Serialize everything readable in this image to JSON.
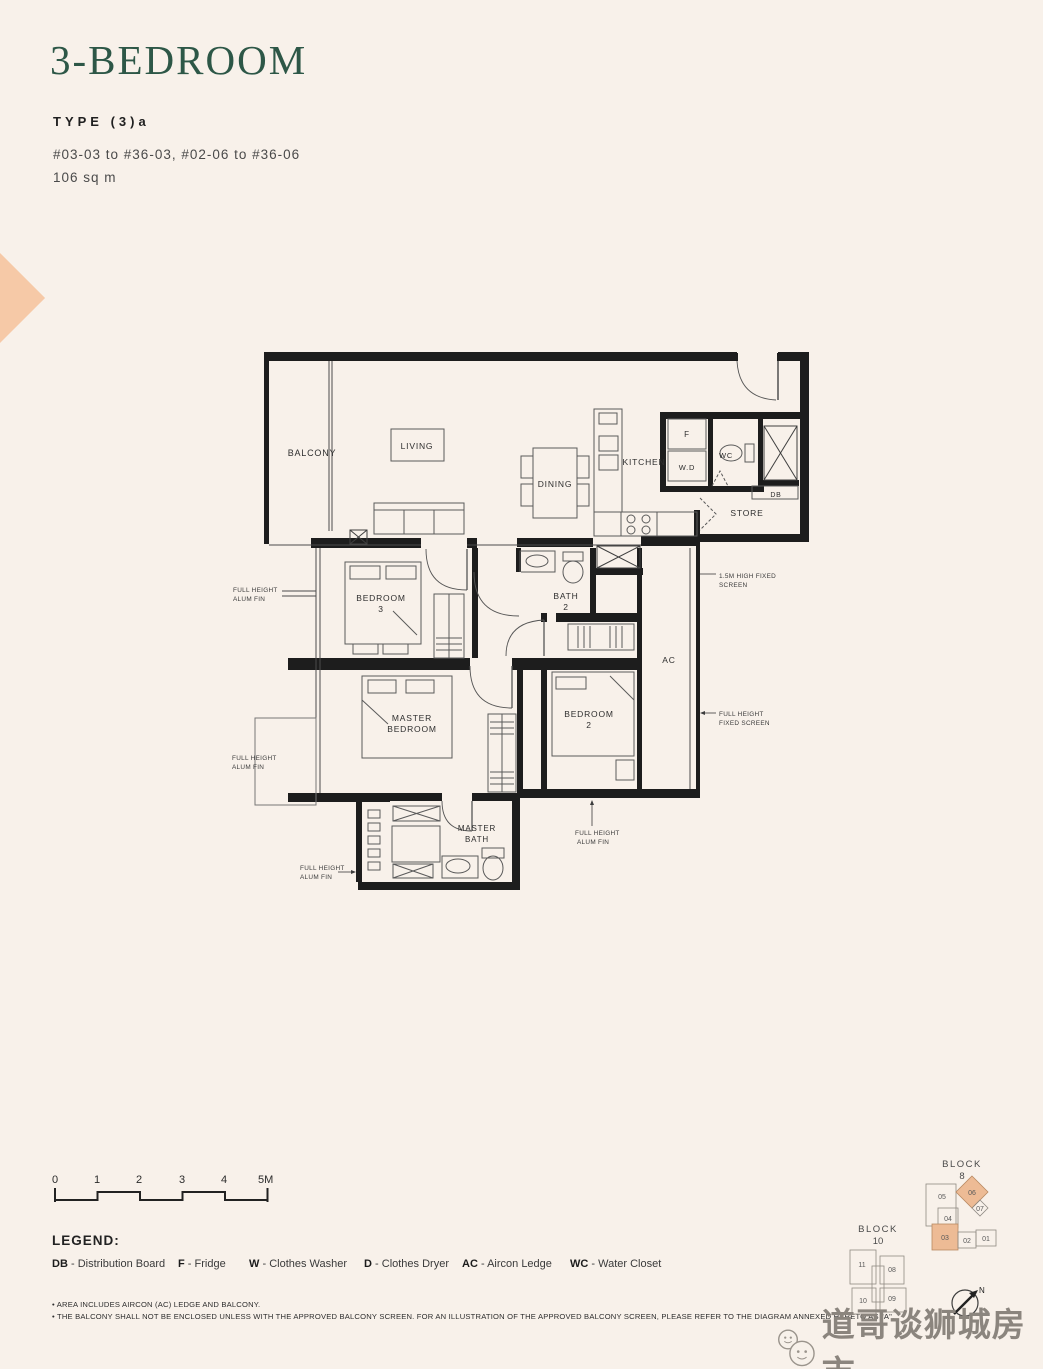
{
  "meta": {
    "bg_color": "#f8f1ea",
    "accent_green": "#2d5747",
    "peach": "#f6c9a7",
    "highlight_unit_fill": "#edbb95"
  },
  "header": {
    "title": "3-BEDROOM",
    "type_label": "TYPE (3)a",
    "units_range": "#03-03 to #36-03, #02-06 to #36-06",
    "area": "106 sq m"
  },
  "plan": {
    "rooms": {
      "balcony": "BALCONY",
      "living": "LIVING",
      "dining": "DINING",
      "kitchen": "KITCHEN",
      "store": "STORE",
      "ac": "AC",
      "wc": "WC",
      "fridge": "F",
      "washer_dryer": "W.D",
      "db": "DB",
      "bedroom3": [
        "BEDROOM",
        "3"
      ],
      "bath2": [
        "BATH",
        "2"
      ],
      "master_bedroom": [
        "MASTER",
        "BEDROOM"
      ],
      "bedroom2": [
        "BEDROOM",
        "2"
      ],
      "master_bath": [
        "MASTER",
        "BATH"
      ]
    },
    "annotations": {
      "alum_fin": [
        "FULL HEIGHT",
        "ALUM FIN"
      ],
      "fixed_screen_15m": [
        "1.5M HIGH FIXED",
        "SCREEN"
      ],
      "fixed_screen_full": [
        "FULL HEIGHT",
        "FIXED SCREEN"
      ]
    }
  },
  "scale_bar": {
    "labels": [
      "0",
      "1",
      "2",
      "3",
      "4",
      "5M"
    ]
  },
  "legend": {
    "title": "LEGEND:",
    "sep": "-",
    "items": [
      {
        "abbr": "DB",
        "name": "Distribution Board"
      },
      {
        "abbr": "F",
        "name": "Fridge"
      },
      {
        "abbr": "W",
        "name": "Clothes Washer"
      },
      {
        "abbr": "D",
        "name": "Clothes Dryer"
      },
      {
        "abbr": "AC",
        "name": "Aircon Ledge"
      },
      {
        "abbr": "WC",
        "name": "Water Closet"
      }
    ]
  },
  "notes": [
    "• AREA INCLUDES AIRCON (AC) LEDGE AND BALCONY.",
    "• THE BALCONY SHALL NOT BE ENCLOSED UNLESS WITH THE APPROVED BALCONY SCREEN. FOR AN ILLUSTRATION OF THE APPROVED BALCONY SCREEN, PLEASE REFER TO THE DIAGRAM ANNEXED HERETO AS \"A\"."
  ],
  "keyplan": {
    "block8": {
      "label": "BLOCK",
      "number": "8",
      "units": [
        "05",
        "06",
        "07",
        "04",
        "03",
        "02",
        "01"
      ]
    },
    "block10": {
      "label": "BLOCK",
      "number": "10",
      "units": [
        "11",
        "08",
        "10",
        "09"
      ]
    },
    "compass_label": "N"
  },
  "watermark": {
    "text": "道哥谈狮城房市"
  }
}
